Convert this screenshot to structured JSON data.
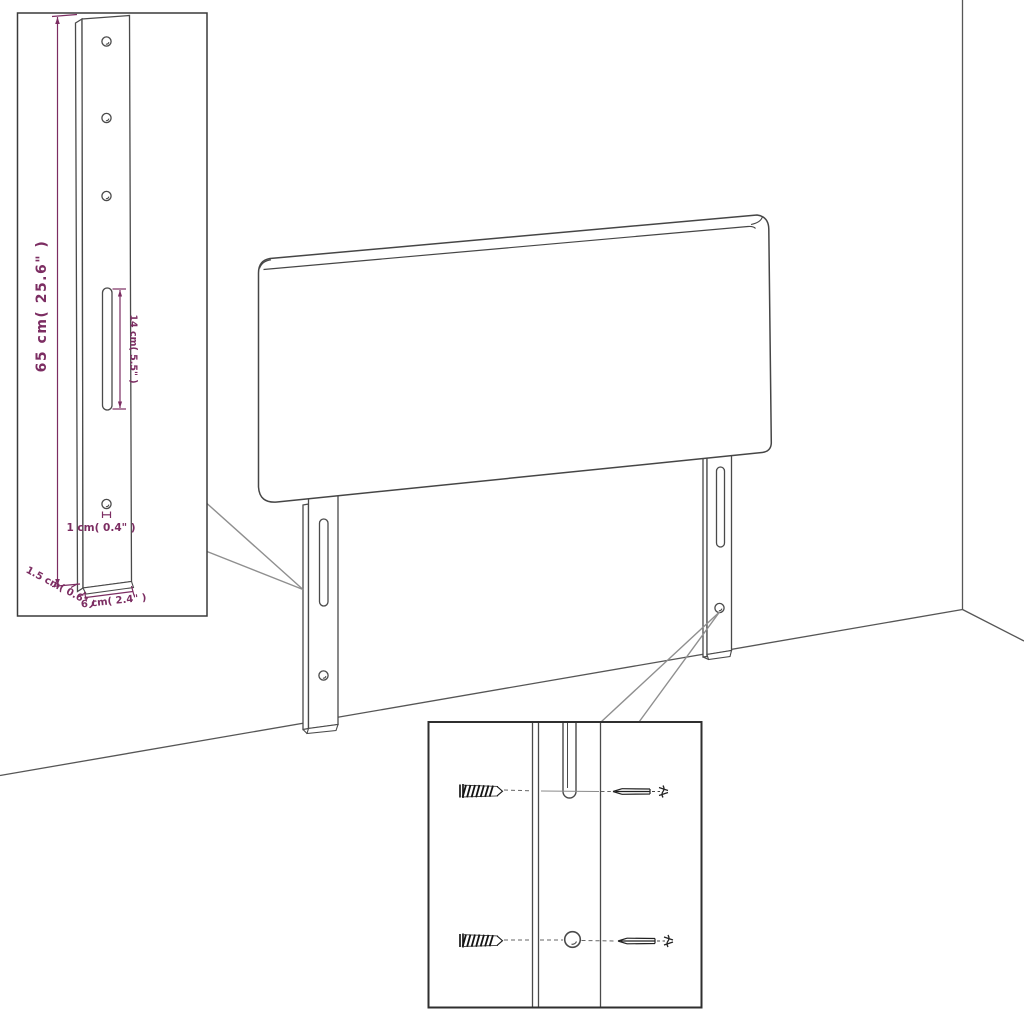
{
  "page": {
    "type": "product-assembly-diagram",
    "subject": "upholstered headboard with two slotted mounting legs, wall corner backdrop, two magnification insets",
    "background": "#ffffff"
  },
  "colors": {
    "outline": "#4a4a4a",
    "dimension": "#7c2d62",
    "leader": "#8f8f8f",
    "inset_border": "#3a3a3a",
    "hardware": "#1a1a1a"
  },
  "leg_detail_inset": {
    "description": "magnified side view of mounting leg with dimensions",
    "dimensions": {
      "height": "65 cm( 25.6\" )",
      "slot_length": "14 cm( 5.5\" )",
      "hole_diameter": "1 cm( 0.4\" )",
      "thickness": "1.5 cm( 0.6\" )",
      "width": "6 cm( 2.4\" )"
    },
    "features": {
      "top_holes": 3,
      "slot": 1,
      "bottom_hole": 1
    }
  },
  "mounting_detail_inset": {
    "description": "magnified view of leg bottom with wall fixing hardware",
    "parts": [
      {
        "name": "wall-plug",
        "count": 2
      },
      {
        "name": "screw",
        "count": 2
      }
    ]
  }
}
